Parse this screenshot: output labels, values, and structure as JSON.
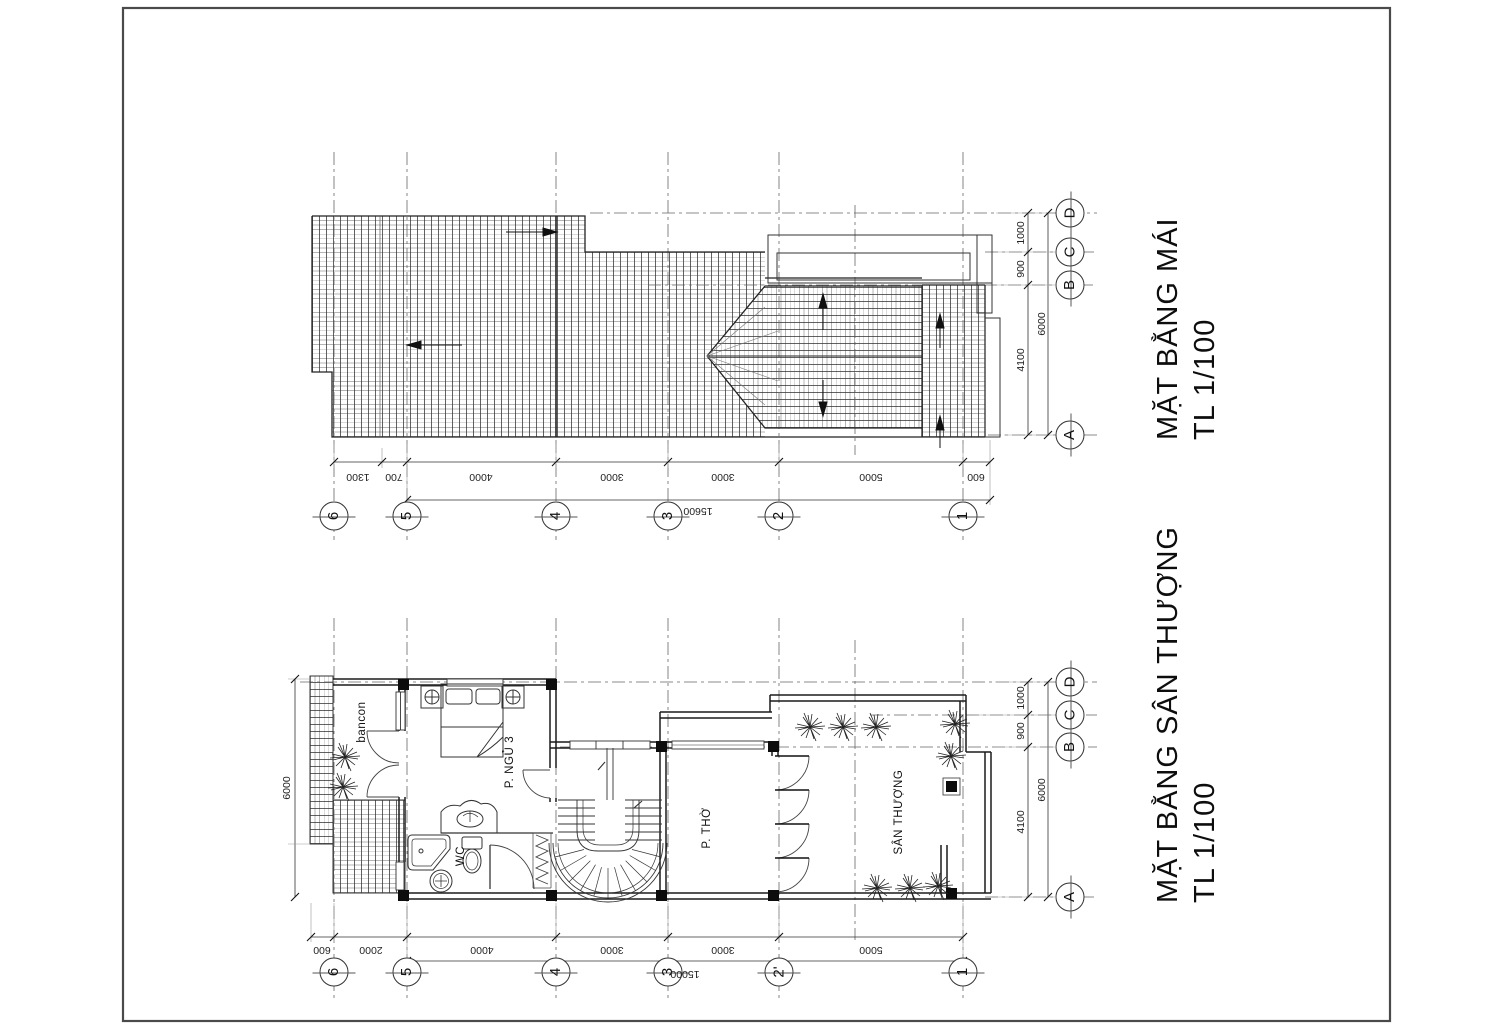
{
  "titles": {
    "roof_line1": "MẶT BẰNG MÁI",
    "roof_line2": "TL 1/100",
    "terrace_line1": "MẶT BẰNG SÂN THƯỢNG",
    "terrace_line2": "TL 1/100"
  },
  "roof_plan": {
    "bottom_dims": [
      "1300",
      "700",
      "4000",
      "3000",
      "3000",
      "5000",
      "600"
    ],
    "bottom_total": "15600",
    "right_dims": [
      "1000",
      "900",
      "4100"
    ],
    "right_total": "6000",
    "col_bubbles": [
      "6",
      "5",
      "4",
      "3",
      "2",
      "1"
    ],
    "row_bubbles": [
      "D",
      "C",
      "B",
      "A"
    ]
  },
  "terrace_plan": {
    "labels": {
      "balcony": "bancon",
      "bedroom": "P. NGỦ 3",
      "wc": "WC",
      "altar": "P. THỜ",
      "terrace": "SÂN THƯỢNG"
    },
    "bottom_dims": [
      "600",
      "2000",
      "4000",
      "3000",
      "3000",
      "5000"
    ],
    "bottom_total": "15000",
    "left_dim": "6000",
    "right_dims": [
      "1000",
      "900",
      "4100"
    ],
    "right_total": "6000",
    "col_bubbles": [
      "6",
      "5",
      "4",
      "3",
      "2'",
      "1"
    ],
    "row_bubbles": [
      "D",
      "C",
      "B",
      "A"
    ]
  }
}
